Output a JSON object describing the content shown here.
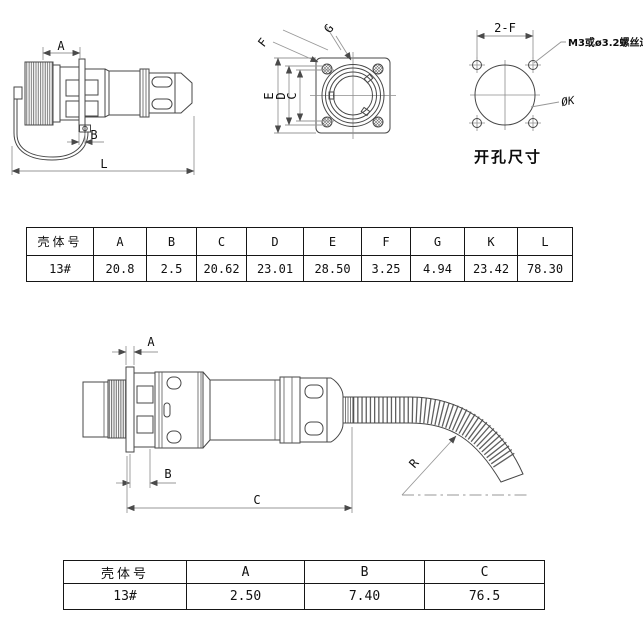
{
  "top_left_view": {
    "dim_a": "A",
    "dim_b": "B",
    "dim_l": "L"
  },
  "front_view": {
    "dim_c": "C",
    "dim_d": "D",
    "dim_e": "E",
    "dim_f": "F",
    "dim_g": "G"
  },
  "hole_pattern_view": {
    "dim_2f": "2-F",
    "screw_hole_note": "M3或ø3.2螺丝过孔",
    "dim_k": "ØK",
    "caption": "开孔尺寸"
  },
  "shell_table_top": {
    "headers": [
      "壳体号",
      "A",
      "B",
      "C",
      "D",
      "E",
      "F",
      "G",
      "K",
      "L"
    ],
    "row": [
      "13#",
      "20.8",
      "2.5",
      "20.62",
      "23.01",
      "28.50",
      "3.25",
      "4.94",
      "23.42",
      "78.30"
    ]
  },
  "bottom_view": {
    "dim_a": "A",
    "dim_b": "B",
    "dim_c": "C",
    "dim_r": "R"
  },
  "shell_table_bottom": {
    "headers": [
      "壳体号",
      "A",
      "B",
      "C"
    ],
    "row": [
      "13#",
      "2.50",
      "7.40",
      "76.5"
    ]
  },
  "colors": {
    "line": "#474747",
    "dim_line": "#979797",
    "text": "#101010"
  }
}
